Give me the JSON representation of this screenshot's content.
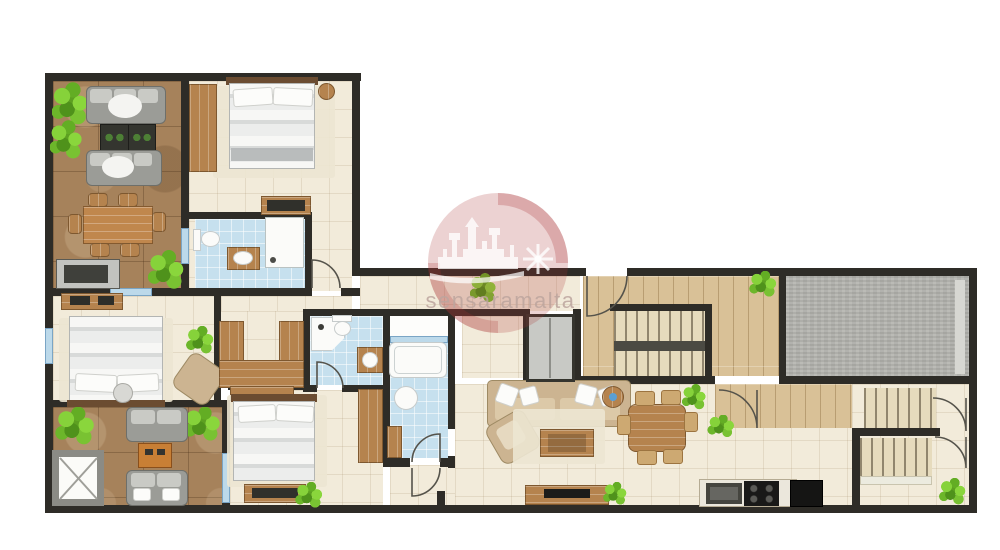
{
  "watermark": {
    "text": "sensaramalta",
    "logo": "walled-city-skyline-and-windmill-in-red-circle",
    "circle_color": "#a93034",
    "text_color": "#bca59d"
  },
  "palette": {
    "wall": "#2e2c27",
    "tile_cream": "#f2ebda",
    "tile_blue": "#c6e0ee",
    "terrace_brown": "#a6825b",
    "wood_floor": "#d9c197",
    "wood_furniture": "#b5834e",
    "gray_area": "#b2b2ad",
    "sofa_gray": "#9b9c97",
    "sofa_beige": "#ccb491",
    "plant_green": "#7cc634",
    "window_blue": "#bcd9ea"
  },
  "floorplan": {
    "type": "apartment-floor-plan",
    "rooms": [
      {
        "name": "terrace lounge (top-left)",
        "furniture": [
          "two grey sofas",
          "two dark coffee tables",
          "timber dining table with six chairs",
          "sideboard",
          "three plants"
        ]
      },
      {
        "name": "bedroom 1 (top)",
        "furniture": [
          "double bed",
          "wardrobe",
          "dresser",
          "round nightstand"
        ]
      },
      {
        "name": "en-suite bathroom 1",
        "furniture": [
          "toilet",
          "washbasin cabinet",
          "shower"
        ]
      },
      {
        "name": "bedroom 2 (left)",
        "furniture": [
          "double bed",
          "dresser",
          "armchair",
          "plant"
        ]
      },
      {
        "name": "dressing area",
        "furniture": [
          "u-shaped wardrobes"
        ]
      },
      {
        "name": "bathroom 2",
        "furniture": [
          "corner shower",
          "toilet",
          "washbasin cabinet"
        ]
      },
      {
        "name": "light shaft",
        "furniture": []
      },
      {
        "name": "bathroom 3",
        "furniture": [
          "bathtub",
          "washbasin",
          "cabinet"
        ]
      },
      {
        "name": "terrace 2 (bottom-left)",
        "furniture": [
          "two grey loveseats",
          "orange coffee table",
          "skylight void marked with X"
        ]
      },
      {
        "name": "bedroom 3 (bottom)",
        "furniture": [
          "double bed",
          "dresser",
          "two wardrobes",
          "plant"
        ]
      },
      {
        "name": "living / dining room",
        "furniture": [
          "beige sofa with pillows",
          "armchair",
          "coffee table on rug",
          "round side table",
          "dining table with six wicker chairs",
          "tv console",
          "kitchen counter with sink and hob",
          "fridge"
        ]
      },
      {
        "name": "entrance hall",
        "furniture": [
          "internal staircase",
          "lift"
        ]
      },
      {
        "name": "grey covered area (top-right)",
        "furniture": []
      },
      {
        "name": "common stairwell (right)",
        "furniture": [
          "two stair flights",
          "two doors",
          "plant"
        ]
      }
    ]
  }
}
